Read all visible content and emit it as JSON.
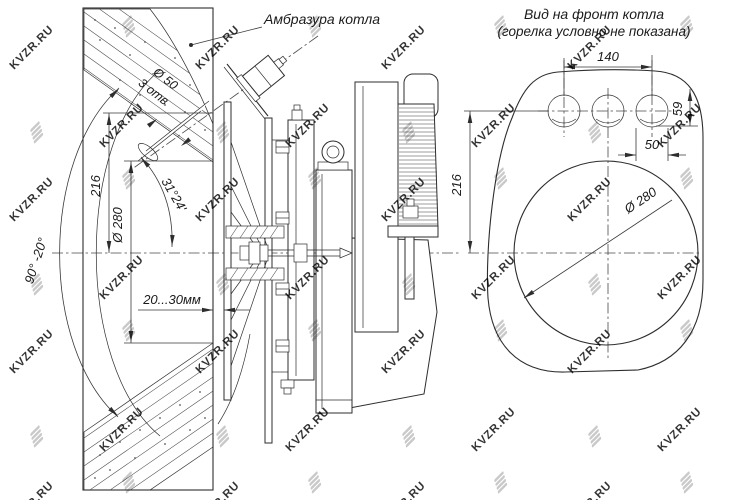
{
  "drawing": {
    "left_view": {
      "callout_embrasure": "Амбразура котла",
      "dim_swivel_range": "90° -20°",
      "dim_axis_height": "216",
      "dim_embrasure_dia": "Ø 280",
      "dim_tilt_angle": "31°24'",
      "dim_wall_gap": "20...30мм",
      "dim_pilot_hole_dia": "Ø 50",
      "dim_pilot_hole_count": "3 отв"
    },
    "front_view": {
      "title_line1": "Вид на фронт котла",
      "title_line2": "(горелка условно не показана)",
      "dim_holes_spacing": "140",
      "dim_holes_drop": "59",
      "dim_hole_dia": "50",
      "dim_center_height": "216",
      "dim_opening_dia": "Ø 280"
    }
  },
  "watermark": {
    "text": "KVZR.RU",
    "color": "#c3c3c3",
    "logo": "kvzr-bars-logo"
  }
}
